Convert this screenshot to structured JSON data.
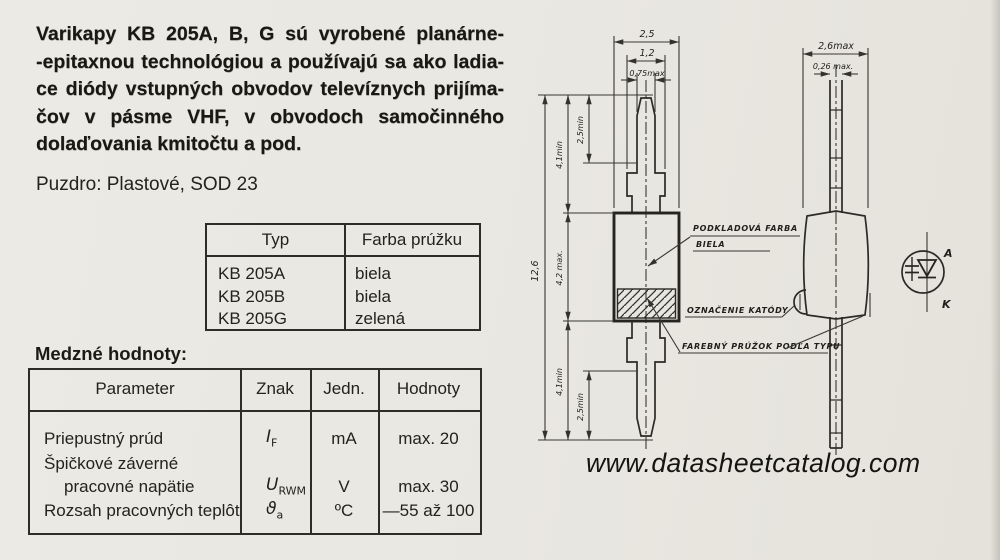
{
  "page": {
    "bg": "#e9e7e1",
    "ink": "#1d1c19"
  },
  "intro": {
    "lines": [
      "Varikapy KB 205A, B, G sú vyrobené planárne-",
      "-epitaxnou technológiou a používajú sa ako ladia-",
      "ce diódy vstupných obvodov televíznych prijíma-",
      "čov v pásme VHF, v obvodoch samočinného",
      "dolaďovania kmitočtu a pod."
    ]
  },
  "package_line": "Puzdro: Plastové, SOD 23",
  "type_table": {
    "col_typ": "Typ",
    "col_farba": "Farba prúžku",
    "rows": [
      {
        "typ": "KB 205A",
        "farba": "biela"
      },
      {
        "typ": "KB 205B",
        "farba": "biela"
      },
      {
        "typ": "KB 205G",
        "farba": "zelená"
      }
    ]
  },
  "limits_table": {
    "heading": "Medzné hodnoty:",
    "col_parameter": "Parameter",
    "col_znak": "Znak",
    "col_jedn": "Jedn.",
    "col_hodnoty": "Hodnoty",
    "r1": {
      "parameter": "Priepustný prúd",
      "znak_sym": "I",
      "znak_sub": "F",
      "jedn": "mA",
      "hodnoty": "max. 20"
    },
    "r2a": {
      "parameter": "Špičkové záverné"
    },
    "r2b": {
      "parameter": "pracovné napätie",
      "znak_sym": "U",
      "znak_sub": "RWM",
      "jedn": "V",
      "hodnoty": "max. 30"
    },
    "r3": {
      "parameter": "Rozsah pracovných teplôt",
      "znak_sym": "ϑ",
      "znak_sub": "a",
      "jedn": "ºC",
      "hodnoty": "—55 až 100"
    }
  },
  "drawing": {
    "front": {
      "dim_body_width": "2,5",
      "dim_crimp_width": "1,2",
      "dim_lead_width": "0,75max",
      "dim_total": "12,6",
      "dim_lead_top": "4,1min",
      "dim_tip_top": "2,5min",
      "dim_body_height": "4,2 max.",
      "dim_lead_bottom": "4,1min",
      "dim_tip_bottom": "2,5min"
    },
    "side": {
      "dim_width": "2,6max",
      "dim_lead_thickness": "0,26 max."
    },
    "callouts": {
      "base_color_line1": "PODKLADOVÁ FARBA",
      "base_color_line2": "BIELA",
      "cathode_mark": "OZNAČENIE KATÓDY",
      "stripe": "FAREBNÝ PRÚŽOK PODĽA TYPU"
    },
    "symbol": {
      "anode": "A",
      "cathode": "K"
    }
  },
  "footer": {
    "url": "www.datasheetcatalog.com"
  }
}
